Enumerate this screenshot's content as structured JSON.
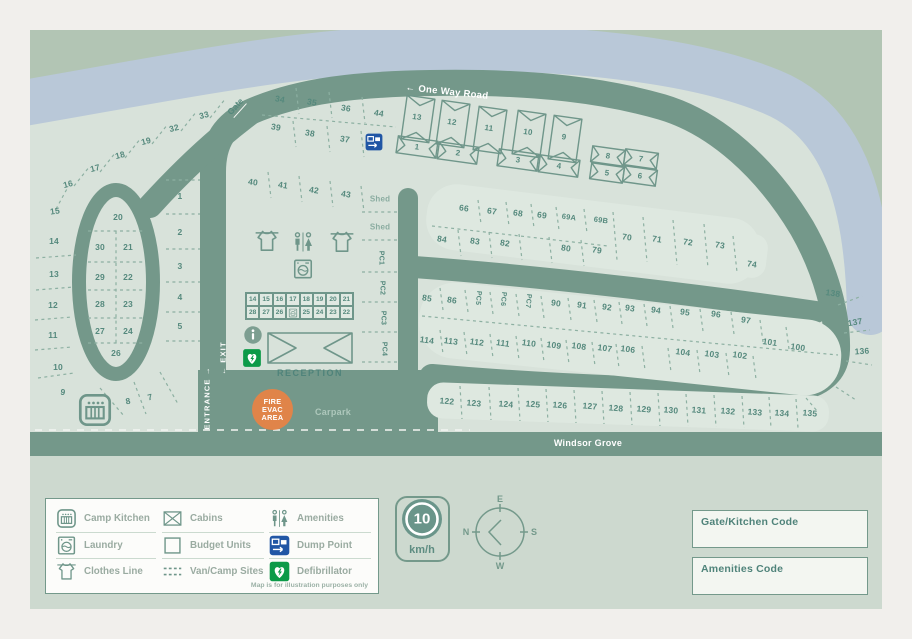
{
  "map": {
    "road_labels": {
      "one_way": "One Way Road",
      "one_way_arrow": "←",
      "windsor": "Windsor Grove",
      "entrance": "ENTRANCE",
      "entrance_arrow": "→",
      "exit": "EXIT",
      "exit_arrow": "←",
      "gate": "Gate",
      "carpark": "Carpark",
      "reception": "RECEPTION"
    },
    "fire_evac": [
      "FIRE",
      "EVAC",
      "AREA"
    ],
    "sites": [
      [
        "15",
        55,
        211,
        -8
      ],
      [
        "16",
        68,
        184,
        -14
      ],
      [
        "17",
        95,
        168,
        -14
      ],
      [
        "18",
        120,
        155,
        -14
      ],
      [
        "19",
        146,
        141,
        -14
      ],
      [
        "32",
        174,
        128,
        -14
      ],
      [
        "33",
        204,
        115,
        -14
      ],
      [
        "34",
        280,
        99,
        10
      ],
      [
        "35",
        312,
        102,
        10
      ],
      [
        "36",
        346,
        108,
        9
      ],
      [
        "44",
        379,
        113,
        9
      ],
      [
        "39",
        276,
        127,
        10
      ],
      [
        "38",
        310,
        133,
        10
      ],
      [
        "37",
        345,
        139,
        9
      ],
      [
        "40",
        253,
        182,
        8
      ],
      [
        "41",
        283,
        185,
        8
      ],
      [
        "42",
        314,
        190,
        8
      ],
      [
        "43",
        346,
        194,
        8
      ],
      [
        "1",
        180,
        196,
        0
      ],
      [
        "2",
        180,
        232,
        0
      ],
      [
        "3",
        180,
        266,
        0
      ],
      [
        "4",
        180,
        297,
        0
      ],
      [
        "5",
        180,
        326,
        0
      ],
      [
        "20",
        118,
        217,
        0
      ],
      [
        "30",
        100,
        247,
        0
      ],
      [
        "21",
        128,
        247,
        0
      ],
      [
        "29",
        100,
        277,
        0
      ],
      [
        "22",
        128,
        277,
        0
      ],
      [
        "28",
        100,
        304,
        0
      ],
      [
        "23",
        128,
        304,
        0
      ],
      [
        "27",
        100,
        331,
        0
      ],
      [
        "24",
        128,
        331,
        0
      ],
      [
        "26",
        116,
        353,
        0
      ],
      [
        "14",
        54,
        241,
        0
      ],
      [
        "13",
        54,
        274,
        0
      ],
      [
        "12",
        53,
        305,
        0
      ],
      [
        "11",
        53,
        335,
        0
      ],
      [
        "10",
        58,
        367,
        0
      ],
      [
        "9",
        63,
        392,
        8
      ],
      [
        "8",
        128,
        401,
        -10
      ],
      [
        "7",
        150,
        397,
        -14
      ],
      [
        "13",
        417,
        117,
        8,
        "cab"
      ],
      [
        "12",
        452,
        122,
        8,
        "cab"
      ],
      [
        "11",
        489,
        128,
        8,
        "cab"
      ],
      [
        "10",
        528,
        132,
        8,
        "cab"
      ],
      [
        "9",
        564,
        137,
        8,
        "cab"
      ],
      [
        "1",
        417,
        147,
        8,
        "cab"
      ],
      [
        "2",
        458,
        153,
        8,
        "cab"
      ],
      [
        "3",
        518,
        160,
        8,
        "cab"
      ],
      [
        "4",
        559,
        166,
        8,
        "cab"
      ],
      [
        "8",
        608,
        156,
        8,
        "cab"
      ],
      [
        "7",
        641,
        159,
        8,
        "cab"
      ],
      [
        "5",
        607,
        173,
        8,
        "cab"
      ],
      [
        "6",
        640,
        176,
        8,
        "cab"
      ],
      [
        "Shed",
        380,
        199,
        0,
        "shed"
      ],
      [
        "Shed",
        380,
        227,
        0,
        "shed"
      ],
      [
        "PC1",
        381,
        258,
        90,
        "pc"
      ],
      [
        "PC2",
        382,
        288,
        90,
        "pc"
      ],
      [
        "PC3",
        383,
        318,
        90,
        "pc"
      ],
      [
        "PC4",
        384,
        349,
        90,
        "pc"
      ],
      [
        "66",
        464,
        208,
        8
      ],
      [
        "67",
        492,
        211,
        8
      ],
      [
        "68",
        518,
        213,
        8
      ],
      [
        "69",
        542,
        215,
        8
      ],
      [
        "69A",
        569,
        217,
        8,
        "s"
      ],
      [
        "69B",
        601,
        220,
        8,
        "s"
      ],
      [
        "70",
        627,
        237,
        8
      ],
      [
        "71",
        657,
        239,
        8
      ],
      [
        "72",
        688,
        242,
        8
      ],
      [
        "73",
        720,
        245,
        8
      ],
      [
        "74",
        752,
        264,
        8
      ],
      [
        "84",
        442,
        239,
        8
      ],
      [
        "83",
        475,
        241,
        8
      ],
      [
        "82",
        505,
        243,
        8
      ],
      [
        "80",
        566,
        248,
        8
      ],
      [
        "79",
        597,
        250,
        8
      ],
      [
        "85",
        427,
        298,
        8
      ],
      [
        "86",
        452,
        300,
        8
      ],
      [
        "PC5",
        478,
        298,
        96,
        "pc"
      ],
      [
        "PC6",
        503,
        299,
        96,
        "pc"
      ],
      [
        "PC7",
        528,
        301,
        96,
        "pc"
      ],
      [
        "90",
        556,
        303,
        8
      ],
      [
        "91",
        582,
        305,
        8
      ],
      [
        "92",
        607,
        307,
        8
      ],
      [
        "93",
        630,
        308,
        8
      ],
      [
        "94",
        656,
        310,
        8
      ],
      [
        "95",
        685,
        312,
        8
      ],
      [
        "96",
        716,
        314,
        8
      ],
      [
        "97",
        746,
        320,
        8
      ],
      [
        "101",
        770,
        342,
        8
      ],
      [
        "100",
        798,
        347,
        8
      ],
      [
        "114",
        427,
        340,
        8
      ],
      [
        "113",
        451,
        341,
        8
      ],
      [
        "112",
        477,
        342,
        8
      ],
      [
        "111",
        503,
        343,
        8
      ],
      [
        "110",
        529,
        343,
        8
      ],
      [
        "109",
        554,
        345,
        8
      ],
      [
        "108",
        579,
        346,
        8
      ],
      [
        "107",
        605,
        348,
        8
      ],
      [
        "106",
        628,
        349,
        8
      ],
      [
        "104",
        683,
        352,
        8
      ],
      [
        "103",
        712,
        354,
        8
      ],
      [
        "102",
        740,
        355,
        8
      ],
      [
        "122",
        447,
        401,
        5
      ],
      [
        "123",
        474,
        403,
        5
      ],
      [
        "124",
        506,
        404,
        5
      ],
      [
        "125",
        533,
        404,
        5
      ],
      [
        "126",
        560,
        405,
        5
      ],
      [
        "127",
        590,
        406,
        5
      ],
      [
        "128",
        616,
        408,
        5
      ],
      [
        "129",
        644,
        409,
        5
      ],
      [
        "130",
        671,
        410,
        5
      ],
      [
        "131",
        699,
        410,
        5
      ],
      [
        "132",
        728,
        411,
        5
      ],
      [
        "133",
        755,
        412,
        5
      ],
      [
        "134",
        782,
        413,
        5
      ],
      [
        "135",
        810,
        413,
        5
      ],
      [
        "138",
        833,
        293,
        8
      ],
      [
        "137",
        855,
        322,
        -10
      ],
      [
        "136",
        862,
        351,
        -4
      ]
    ],
    "budget_grid": {
      "row1": [
        "14",
        "15",
        "16",
        "17",
        "18",
        "19",
        "20",
        "21"
      ],
      "row2": [
        "28",
        "27",
        "26",
        "",
        "25",
        "24",
        "23",
        "22"
      ]
    },
    "map_icons": [
      {
        "icon": "clothes-line",
        "x": 267,
        "y": 241,
        "s": 26
      },
      {
        "icon": "amenities",
        "x": 303,
        "y": 242,
        "s": 24
      },
      {
        "icon": "clothes-line",
        "x": 342,
        "y": 242,
        "s": 26
      },
      {
        "icon": "laundry",
        "x": 303,
        "y": 269,
        "s": 22
      },
      {
        "icon": "info",
        "x": 253,
        "y": 335,
        "s": 19
      },
      {
        "icon": "defibrillator",
        "x": 252,
        "y": 358,
        "s": 19
      },
      {
        "icon": "dump-point",
        "x": 374,
        "y": 142,
        "s": 18
      },
      {
        "icon": "camp-kitchen",
        "x": 95,
        "y": 410,
        "s": 36
      }
    ]
  },
  "legend": {
    "columns": [
      [
        {
          "icon": "camp-kitchen",
          "label": "Camp Kitchen"
        },
        {
          "icon": "laundry",
          "label": "Laundry"
        },
        {
          "icon": "clothes-line",
          "label": "Clothes Line"
        }
      ],
      [
        {
          "icon": "cabins",
          "label": "Cabins"
        },
        {
          "icon": "budget-units",
          "label": "Budget Units"
        },
        {
          "icon": "van-camp",
          "label": "Van/Camp Sites"
        }
      ],
      [
        {
          "icon": "amenities",
          "label": "Amenities"
        },
        {
          "icon": "dump-point",
          "label": "Dump Point"
        },
        {
          "icon": "defibrillator",
          "label": "Defibrillator"
        }
      ]
    ],
    "disclaimer": "Map is for illustration purposes only"
  },
  "speed_sign": {
    "value": "10",
    "unit": "km/h"
  },
  "compass": {
    "top": "E",
    "right": "S",
    "bottom": "W",
    "left": "N"
  },
  "codes": [
    {
      "label": "Gate/Kitchen Code"
    },
    {
      "label": "Amenities Code"
    }
  ],
  "colors": {
    "road": "#74988a",
    "river": "#b9c8d8",
    "sage": "#b2c5b4",
    "map_bg": "#d8e2da",
    "island": "#dee8e0",
    "accent_text": "#55897d",
    "fire_orange": "#e08449",
    "dump_blue": "#2156a5",
    "defib_green": "#0c9a48"
  }
}
